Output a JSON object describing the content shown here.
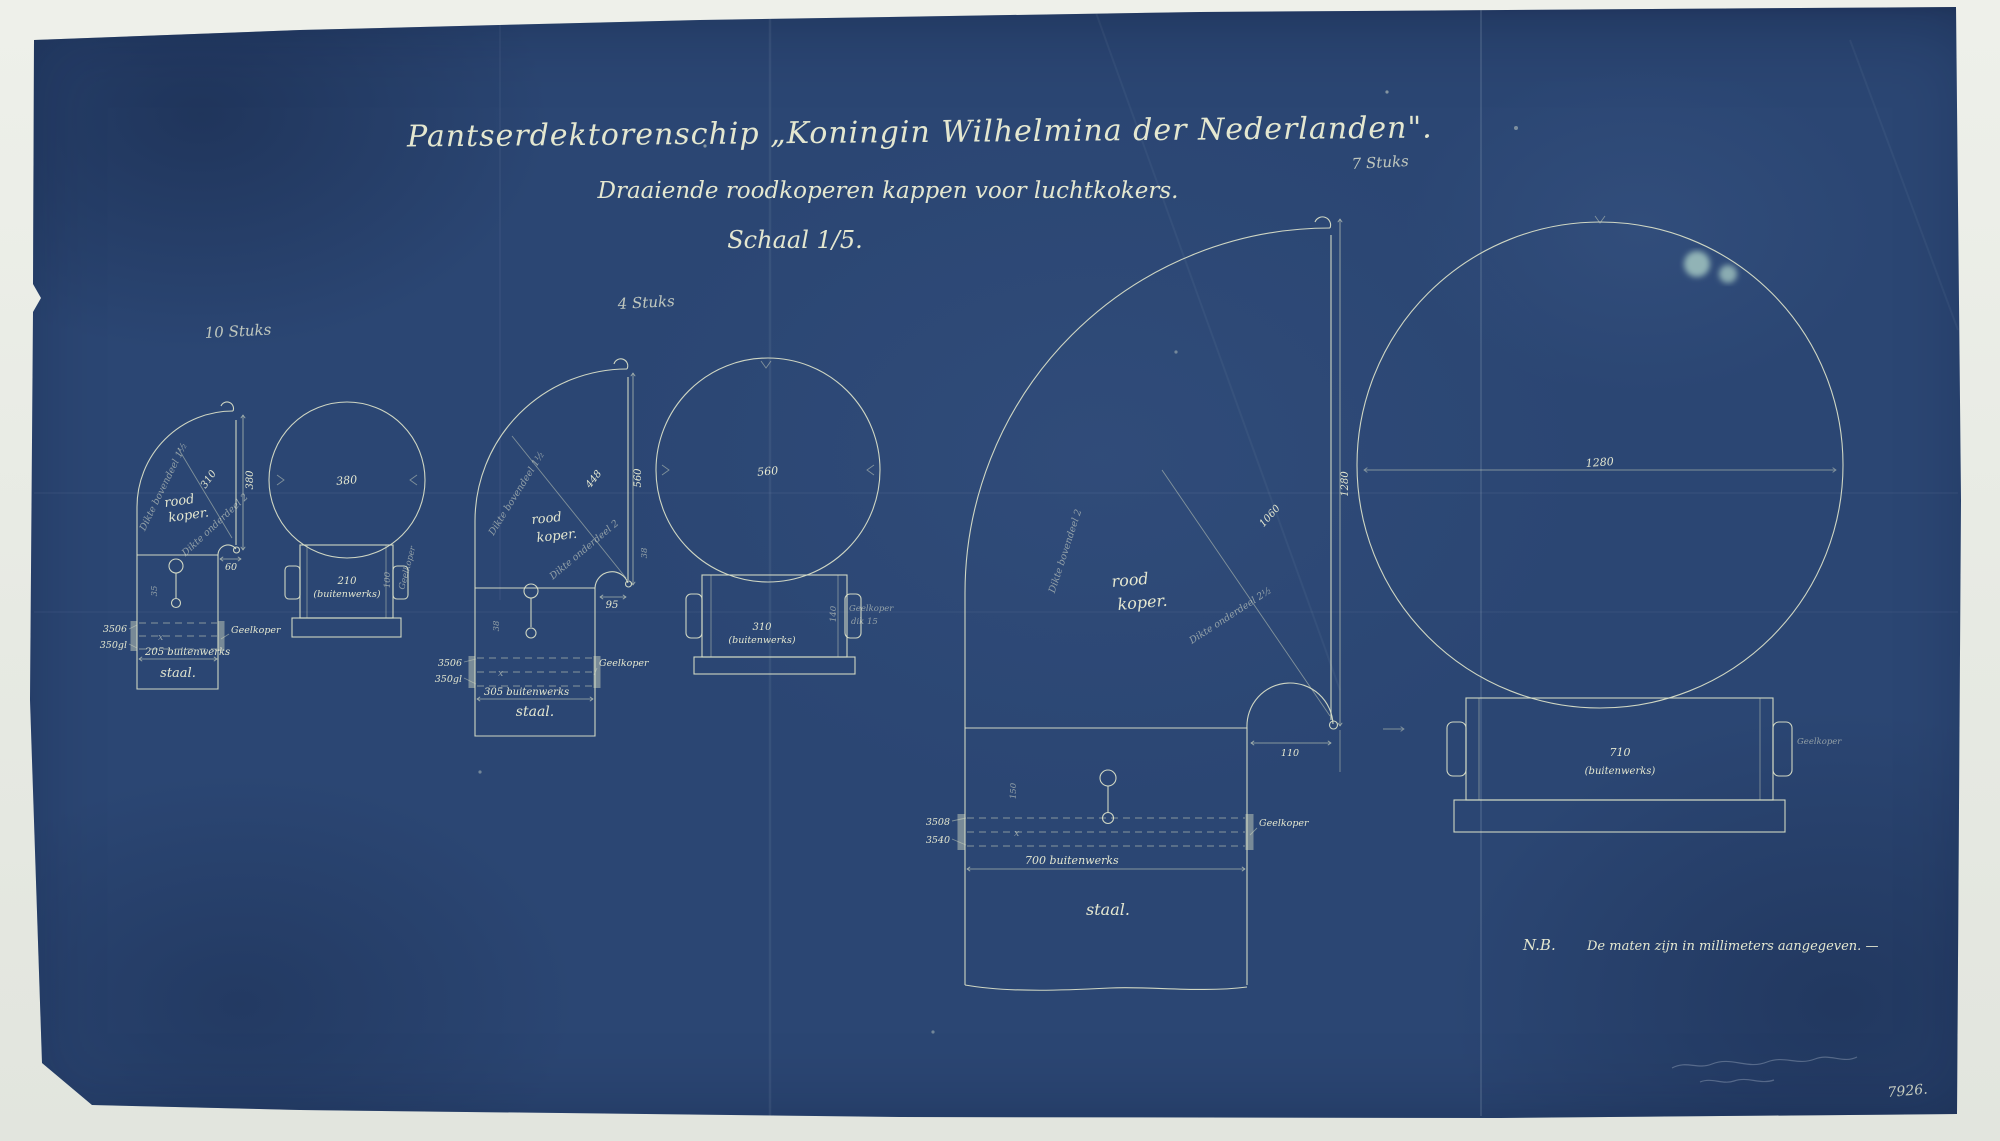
{
  "document": {
    "title": "Pantserdektorenschip „Koningin Wilhelmina der Nederlanden\".",
    "subtitle": "Draaiende roodkoperen kappen voor luchtkokers.",
    "scale_label": "Schaal 1/5.",
    "note_prefix": "N.B.",
    "note_text": "De maten zijn in millimeters aangegeven. —",
    "sheet_number": "7926.",
    "ink_color": "#dde3ca",
    "paper_color": "#2b4673"
  },
  "groups": [
    {
      "quantity_label": "10 Stuks",
      "side_view": {
        "material_line1": "rood",
        "material_line2": "koper.",
        "height_dim": "380",
        "diagonal_dim": "310",
        "thickness_top_label": "Dikte bovendeel 1½",
        "thickness_bottom_label": "Dikte onderdeel 2",
        "fillet_dim": "60",
        "spindle_dim": "35",
        "x_mark": "x",
        "band_dim_a": "3506",
        "band_dim_b": "350gl",
        "band_material": "Geelkoper",
        "width_dim": "205 buitenwerks",
        "base_material": "staal."
      },
      "top_view": {
        "diameter_dim": "380"
      },
      "front_view": {
        "diameter_dim": "210",
        "diameter_note": "(buitenwerks)",
        "side_dim": "100",
        "side_material": "Geelkoper"
      }
    },
    {
      "quantity_label": "4 Stuks",
      "side_view": {
        "material_line1": "rood",
        "material_line2": "koper.",
        "height_dim": "560",
        "diagonal_dim": "448",
        "thickness_top_label": "Dikte bovendeel 1½",
        "thickness_bottom_label": "Dikte onderdeel 2",
        "fillet_dim": "95",
        "fillet_side_dim": "38",
        "spindle_dim": "38",
        "x_mark": "x",
        "band_dim_a": "3506",
        "band_dim_b": "350gl",
        "band_material": "Geelkoper",
        "width_dim": "305 buitenwerks",
        "base_material": "staal."
      },
      "top_view": {
        "diameter_dim": "560"
      },
      "front_view": {
        "diameter_dim": "310",
        "diameter_note": "(buitenwerks)",
        "side_dim": "140",
        "side_material": "Geelkoper",
        "side_note": "dik 15"
      }
    },
    {
      "quantity_label": "7 Stuks",
      "side_view": {
        "material_line1": "rood",
        "material_line2": "koper.",
        "height_dim": "1280",
        "diagonal_dim": "1060",
        "thickness_top_label": "Dikte bovendeel 2",
        "thickness_bottom_label": "Dikte onderdeel 2½",
        "fillet_dim": "110",
        "spindle_dim": "150",
        "x_mark": "x",
        "band_dim_a": "3508",
        "band_dim_b": "3540",
        "band_material": "Geelkoper",
        "width_dim": "700 buitenwerks",
        "base_material": "staal."
      },
      "top_view": {
        "diameter_dim": "1280"
      },
      "front_view": {
        "diameter_dim": "710",
        "diameter_note": "(buitenwerks)",
        "side_material": "Geelkoper"
      }
    }
  ]
}
